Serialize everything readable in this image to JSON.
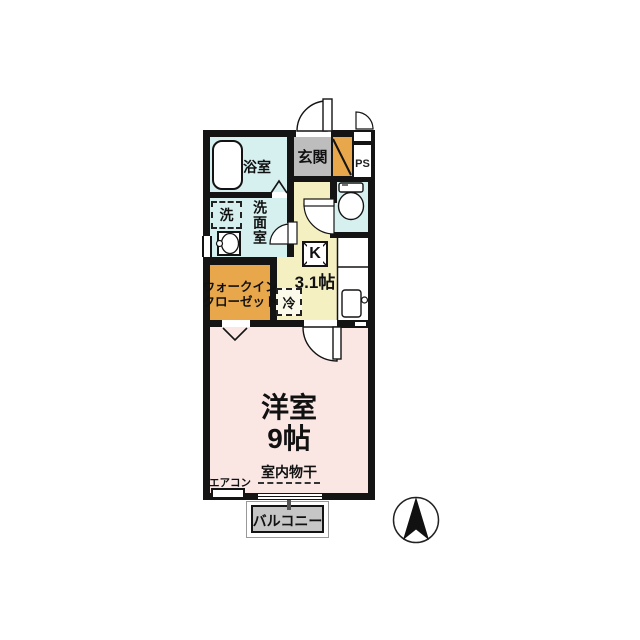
{
  "colors": {
    "wall": "#141414",
    "water_rooms": "#d5f0ef",
    "entrance_floor": "#bdbdbd",
    "cabinet": "#e8a74a",
    "kitchen_floor": "#f5f0c2",
    "room_floor": "#fae7e4",
    "balcony_floor": "#c6c6c6"
  },
  "rooms": {
    "bathroom": {
      "label": "浴室"
    },
    "entrance": {
      "label": "玄関"
    },
    "pipe_space": {
      "label": "PS"
    },
    "washroom": {
      "label": "洗面室"
    },
    "washing_machine": {
      "label": "洗"
    },
    "walk_in_closet": {
      "label_line1": "ウォークイン",
      "label_line2": "クローゼット"
    },
    "kitchen": {
      "label": "K",
      "size": "3.1帖"
    },
    "refrigerator": {
      "label": "冷"
    },
    "western_room": {
      "label": "洋室",
      "size": "9帖"
    },
    "balcony": {
      "label": "バルコニー"
    }
  },
  "annotations": {
    "indoor_drying": "室内物干",
    "air_conditioner": "エアコン"
  }
}
